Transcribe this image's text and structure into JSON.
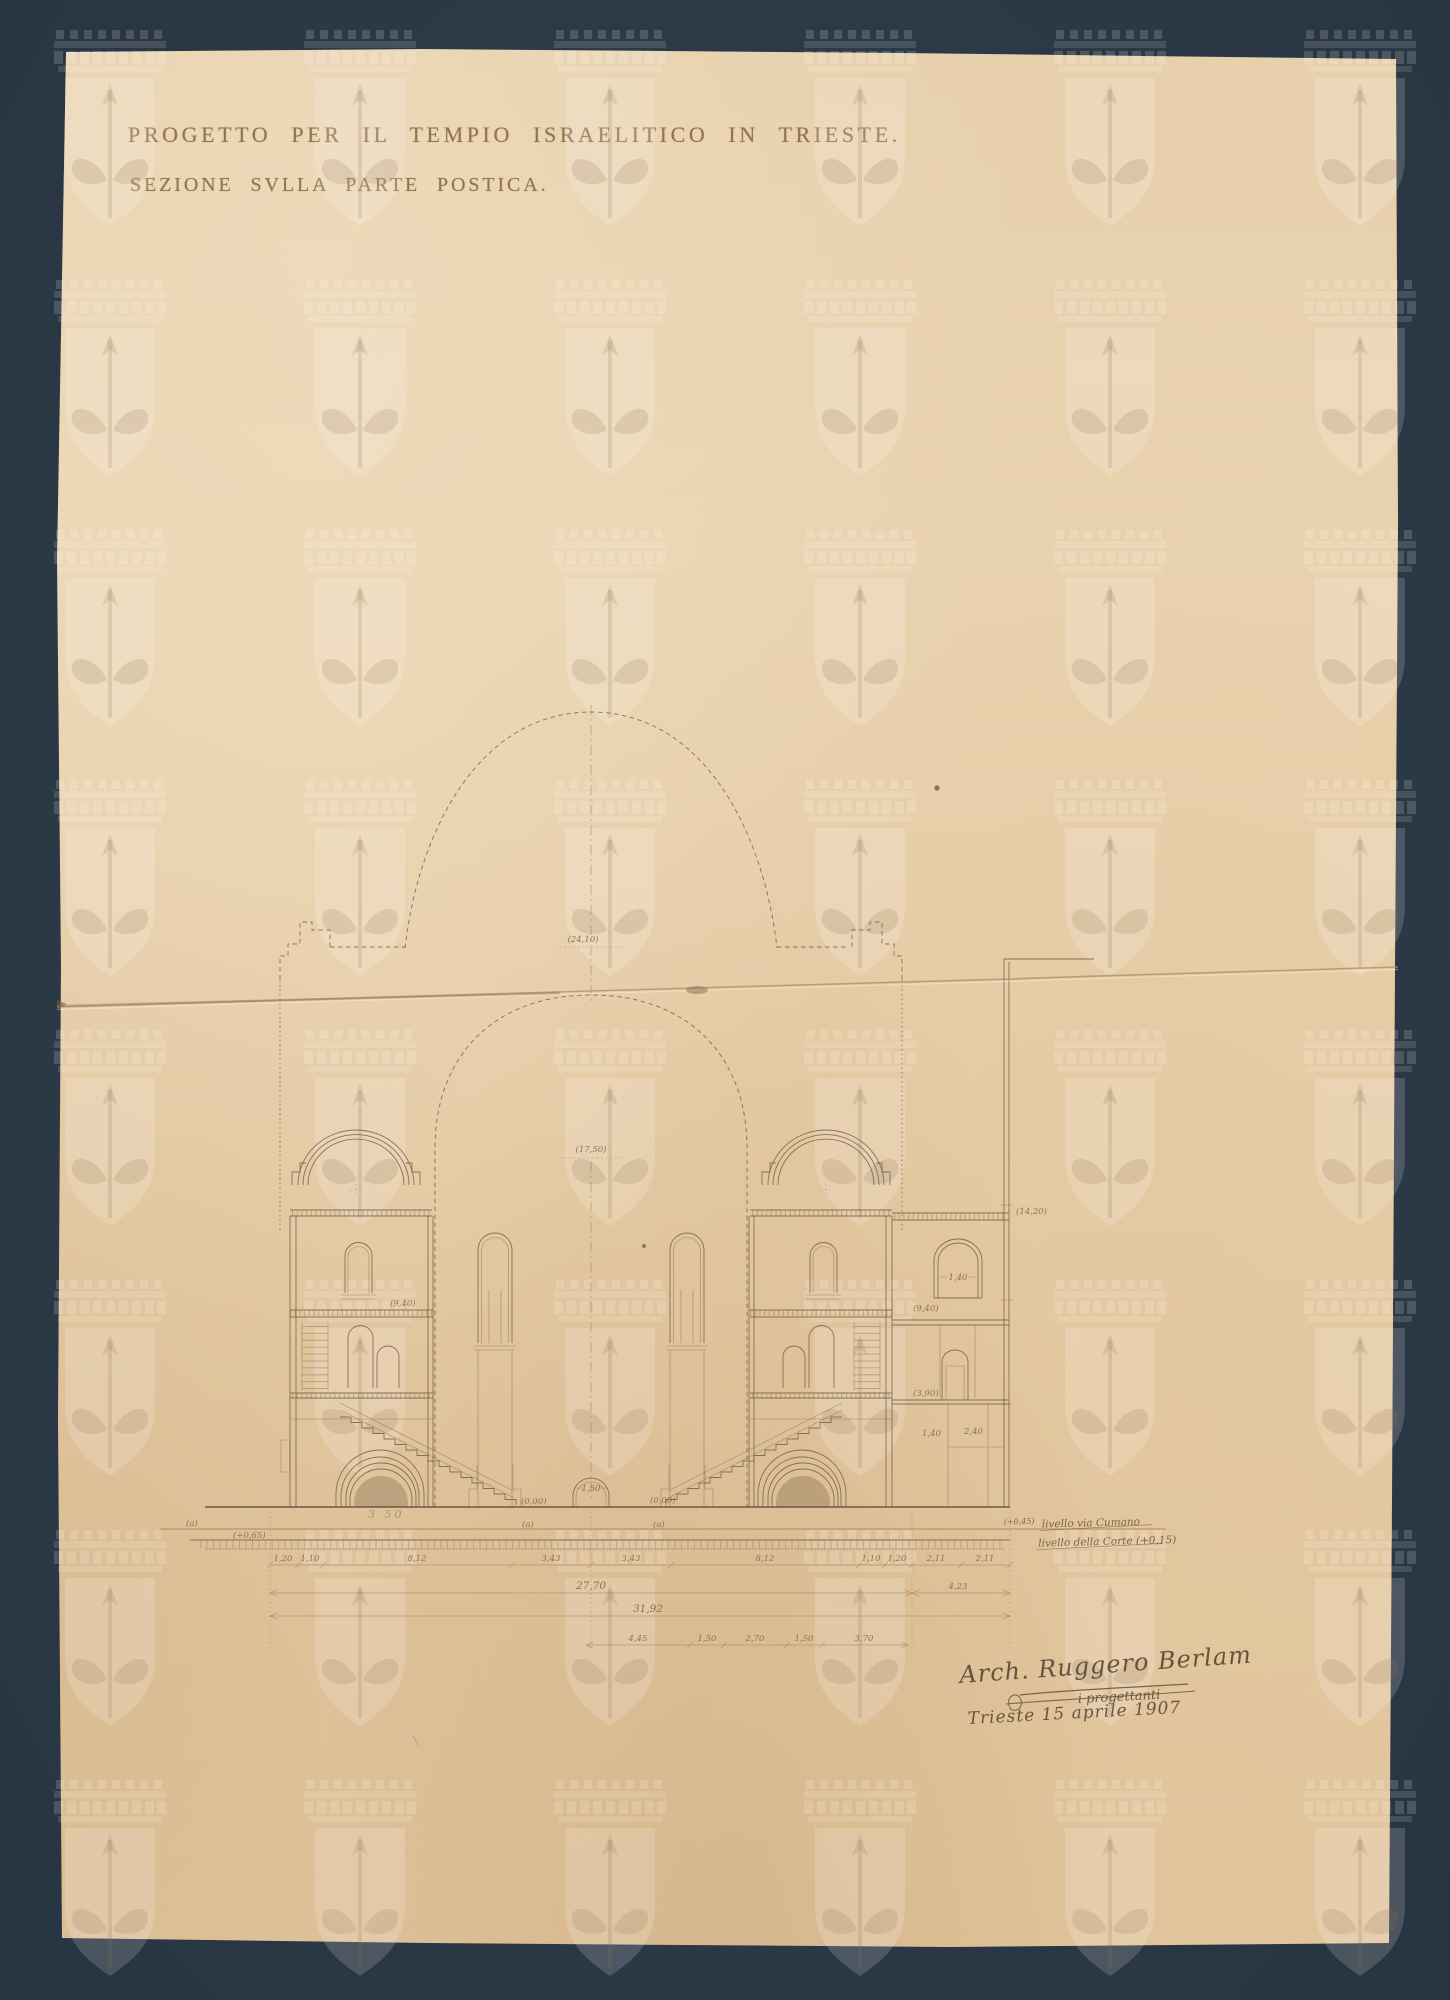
{
  "titles": {
    "line1": "PROGETTO PER IL TEMPIO ISRAELITICO IN TRIESTE.",
    "line2": "SEZIONE SVLLA PARTE POSTICA."
  },
  "labels": {
    "dome_level": "(24,10)",
    "arch_level": "(17,50)",
    "annex_roof_level": "(14,20)",
    "gallery_level_left": "(9,40)",
    "gallery_level_annex": "(9,40)",
    "annex_sill_level": "(3,90)",
    "door_width": "1,50",
    "annex_window_width": "1,40",
    "annex_room_a": "1,40",
    "annex_room_b": "2,40",
    "stair_level_left": "(0,00)",
    "stair_level_right": "(0,00)",
    "axis_a": "(a)",
    "axis_b": "(a)",
    "axis_c": "(a)",
    "terrain_level": "(+0,65)",
    "pencil_note": "3 50"
  },
  "dimensions": {
    "row1": [
      "1,20",
      "1,10",
      "8,12",
      "3,43",
      "3,43",
      "8,12",
      "1,10",
      "1,20",
      "2,11",
      "2,11"
    ],
    "total_main": "27,70",
    "annex_width": "4,23",
    "total": "31,92",
    "row4": [
      "4,45",
      "1,50",
      "2,70",
      "1,50",
      "3,70"
    ]
  },
  "notes": {
    "street_level_value": "(+0,45)",
    "street_level": "livello via Cumano",
    "court_level": "livello della Corte (+0,15)"
  },
  "signature": {
    "name": "Arch. Ruggero Berlam",
    "role": "i progettanti",
    "date": "Trieste 15 aprile 1907"
  }
}
